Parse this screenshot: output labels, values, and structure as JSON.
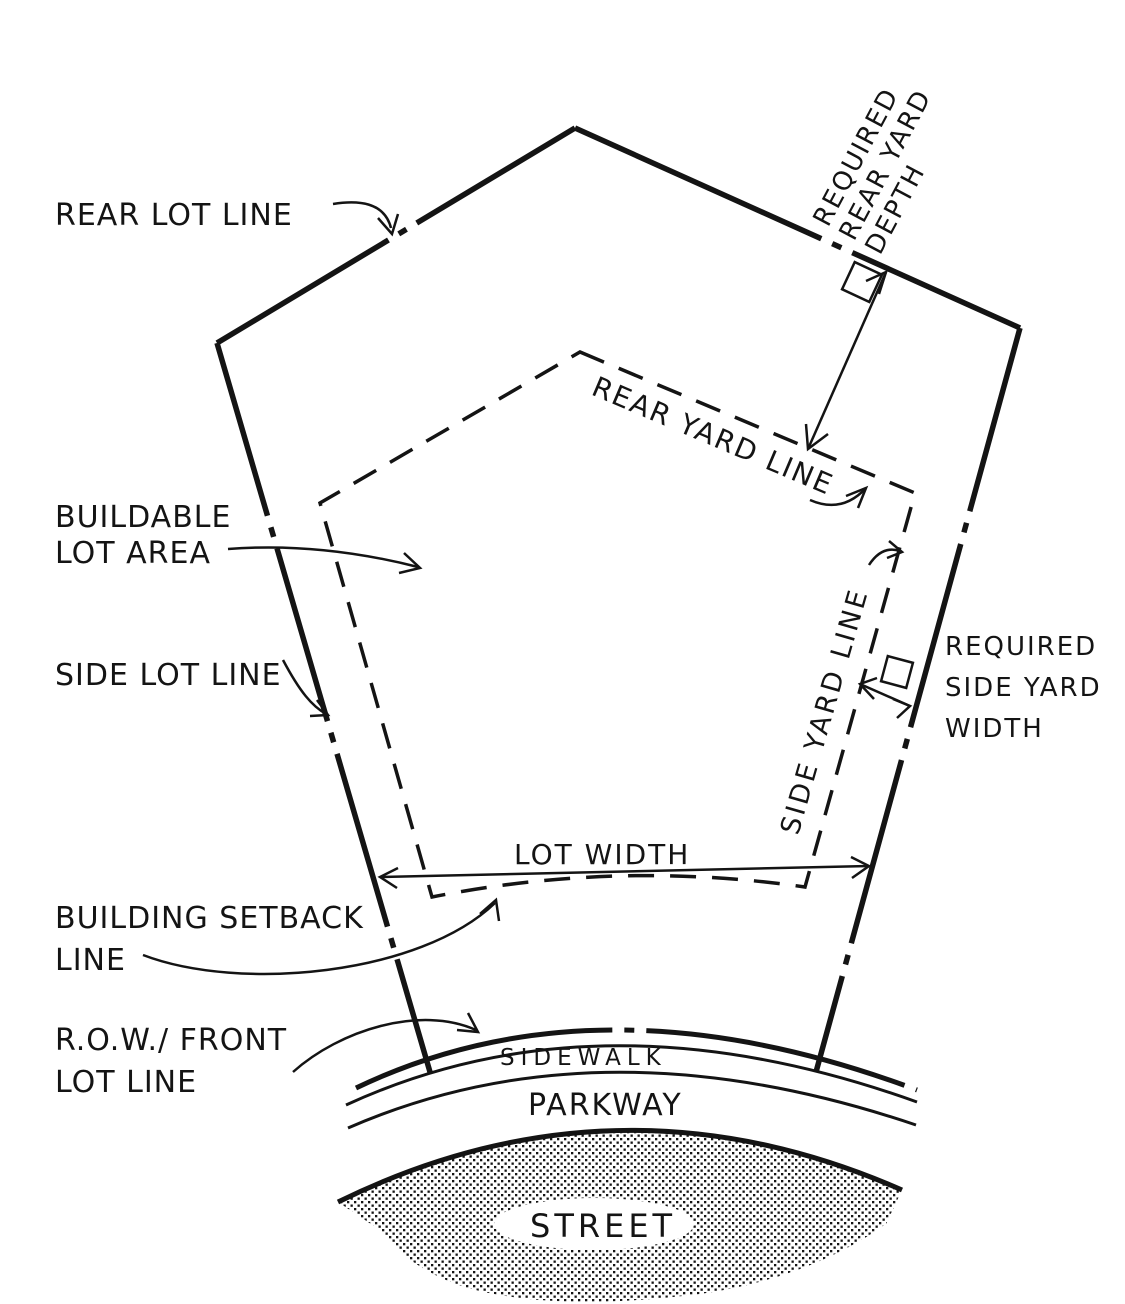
{
  "diagram": {
    "title": "lot-and-yard-requirements-diagram",
    "colors": {
      "ink": "#141414",
      "paper": "#ffffff",
      "street_halftone": "#141414"
    },
    "labels": {
      "rear_lot_line": "REAR LOT LINE",
      "required_rear_yard_depth_l1": "REQUIRED",
      "required_rear_yard_depth_l2": "REAR YARD",
      "required_rear_yard_depth_l3": "DEPTH",
      "rear_yard_line": "REAR YARD LINE",
      "buildable_lot_area_l1": "BUILDABLE",
      "buildable_lot_area_l2": "LOT AREA",
      "side_lot_line": "SIDE LOT LINE",
      "side_yard_line": "SIDE YARD LINE",
      "required_side_yard_width_l1": "REQUIRED",
      "required_side_yard_width_l2": "SIDE YARD",
      "required_side_yard_width_l3": "WIDTH",
      "lot_width": "LOT WIDTH",
      "building_setback_line_l1": "BUILDING SETBACK",
      "building_setback_line_l2": "LINE",
      "row_front_lot_line_l1": "R.O.W./ FRONT",
      "row_front_lot_line_l2": "LOT  LINE",
      "sidewalk": "SIDEWALK",
      "parkway": "PARKWAY",
      "street": "STREET"
    }
  }
}
